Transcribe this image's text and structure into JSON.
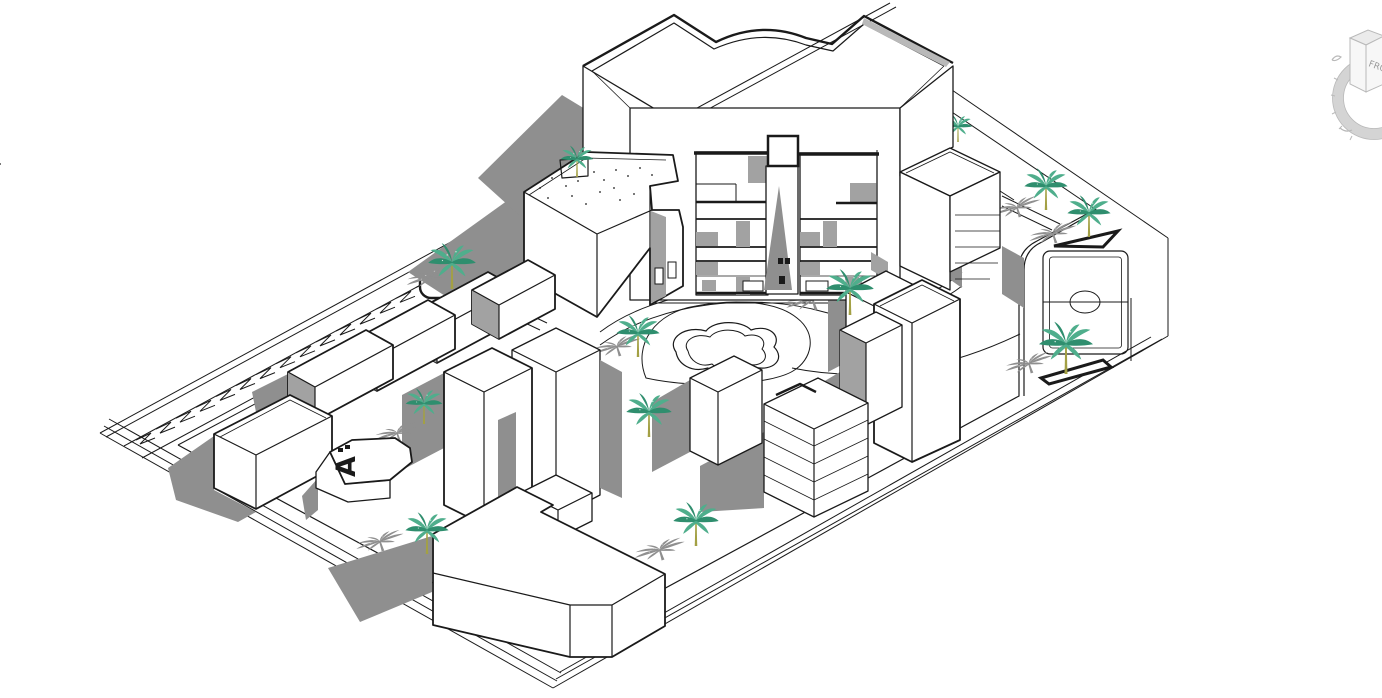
{
  "scene": {
    "background": "#ffffff",
    "ink": "#1a1a1a",
    "shadow": "#8f8f8f",
    "shade": "#a2a2a2",
    "band_gray": "#b9b9b9"
  },
  "palette": {
    "palm_frond": "#4fae8c",
    "palm_frond_dark": "#2f8e6e",
    "palm_trunk": "#a3a044",
    "viewcube_line": "#b9b9b9",
    "viewcube_face": "#f7f7f7",
    "viewcube_top": "#ebebeb",
    "viewcube_ring": "#d4d4d4",
    "viewcube_text": "#9a9a9a"
  },
  "viewcube": {
    "front_label": "FRONT"
  },
  "labels": {
    "building_a": "A"
  },
  "parking": {
    "start_x": 136,
    "start_y": 436,
    "step_x": 20,
    "step_y": -10.9,
    "count": 15
  },
  "palms": [
    {
      "id": "palm-planter",
      "x": 452,
      "y": 289,
      "s": 1.1
    },
    {
      "id": "palm-roof-courtyard",
      "x": 577,
      "y": 177,
      "s": 0.75
    },
    {
      "id": "palm-plaza-west",
      "x": 638,
      "y": 357,
      "s": 1.0
    },
    {
      "id": "palm-plaza-center",
      "x": 649,
      "y": 437,
      "s": 1.05
    },
    {
      "id": "palm-plaza-east",
      "x": 850,
      "y": 315,
      "s": 1.1
    },
    {
      "id": "palm-north-east-1",
      "x": 1046,
      "y": 210,
      "s": 1.0
    },
    {
      "id": "palm-north-east-2",
      "x": 1089,
      "y": 237,
      "s": 1.0
    },
    {
      "id": "palm-court",
      "x": 1066,
      "y": 374,
      "s": 1.25
    },
    {
      "id": "palm-south-center",
      "x": 696,
      "y": 546,
      "s": 1.05
    },
    {
      "id": "palm-south-west",
      "x": 427,
      "y": 554,
      "s": 1.0
    },
    {
      "id": "palm-behind-tower",
      "x": 958,
      "y": 142,
      "s": 0.65,
      "behind": true
    },
    {
      "id": "palm-rowhouse",
      "x": 424,
      "y": 424,
      "s": 0.85
    }
  ],
  "shadow_palms": [
    {
      "x": 435,
      "y": 287,
      "s": 0.9
    },
    {
      "x": 620,
      "y": 356,
      "s": 0.85
    },
    {
      "x": 816,
      "y": 310,
      "s": 0.95
    },
    {
      "x": 1020,
      "y": 217,
      "s": 0.85
    },
    {
      "x": 1056,
      "y": 243,
      "s": 0.85
    },
    {
      "x": 383,
      "y": 551,
      "s": 0.85
    },
    {
      "x": 663,
      "y": 560,
      "s": 0.9
    },
    {
      "x": 1032,
      "y": 373,
      "s": 0.85
    },
    {
      "x": 400,
      "y": 442,
      "s": 0.8
    }
  ]
}
